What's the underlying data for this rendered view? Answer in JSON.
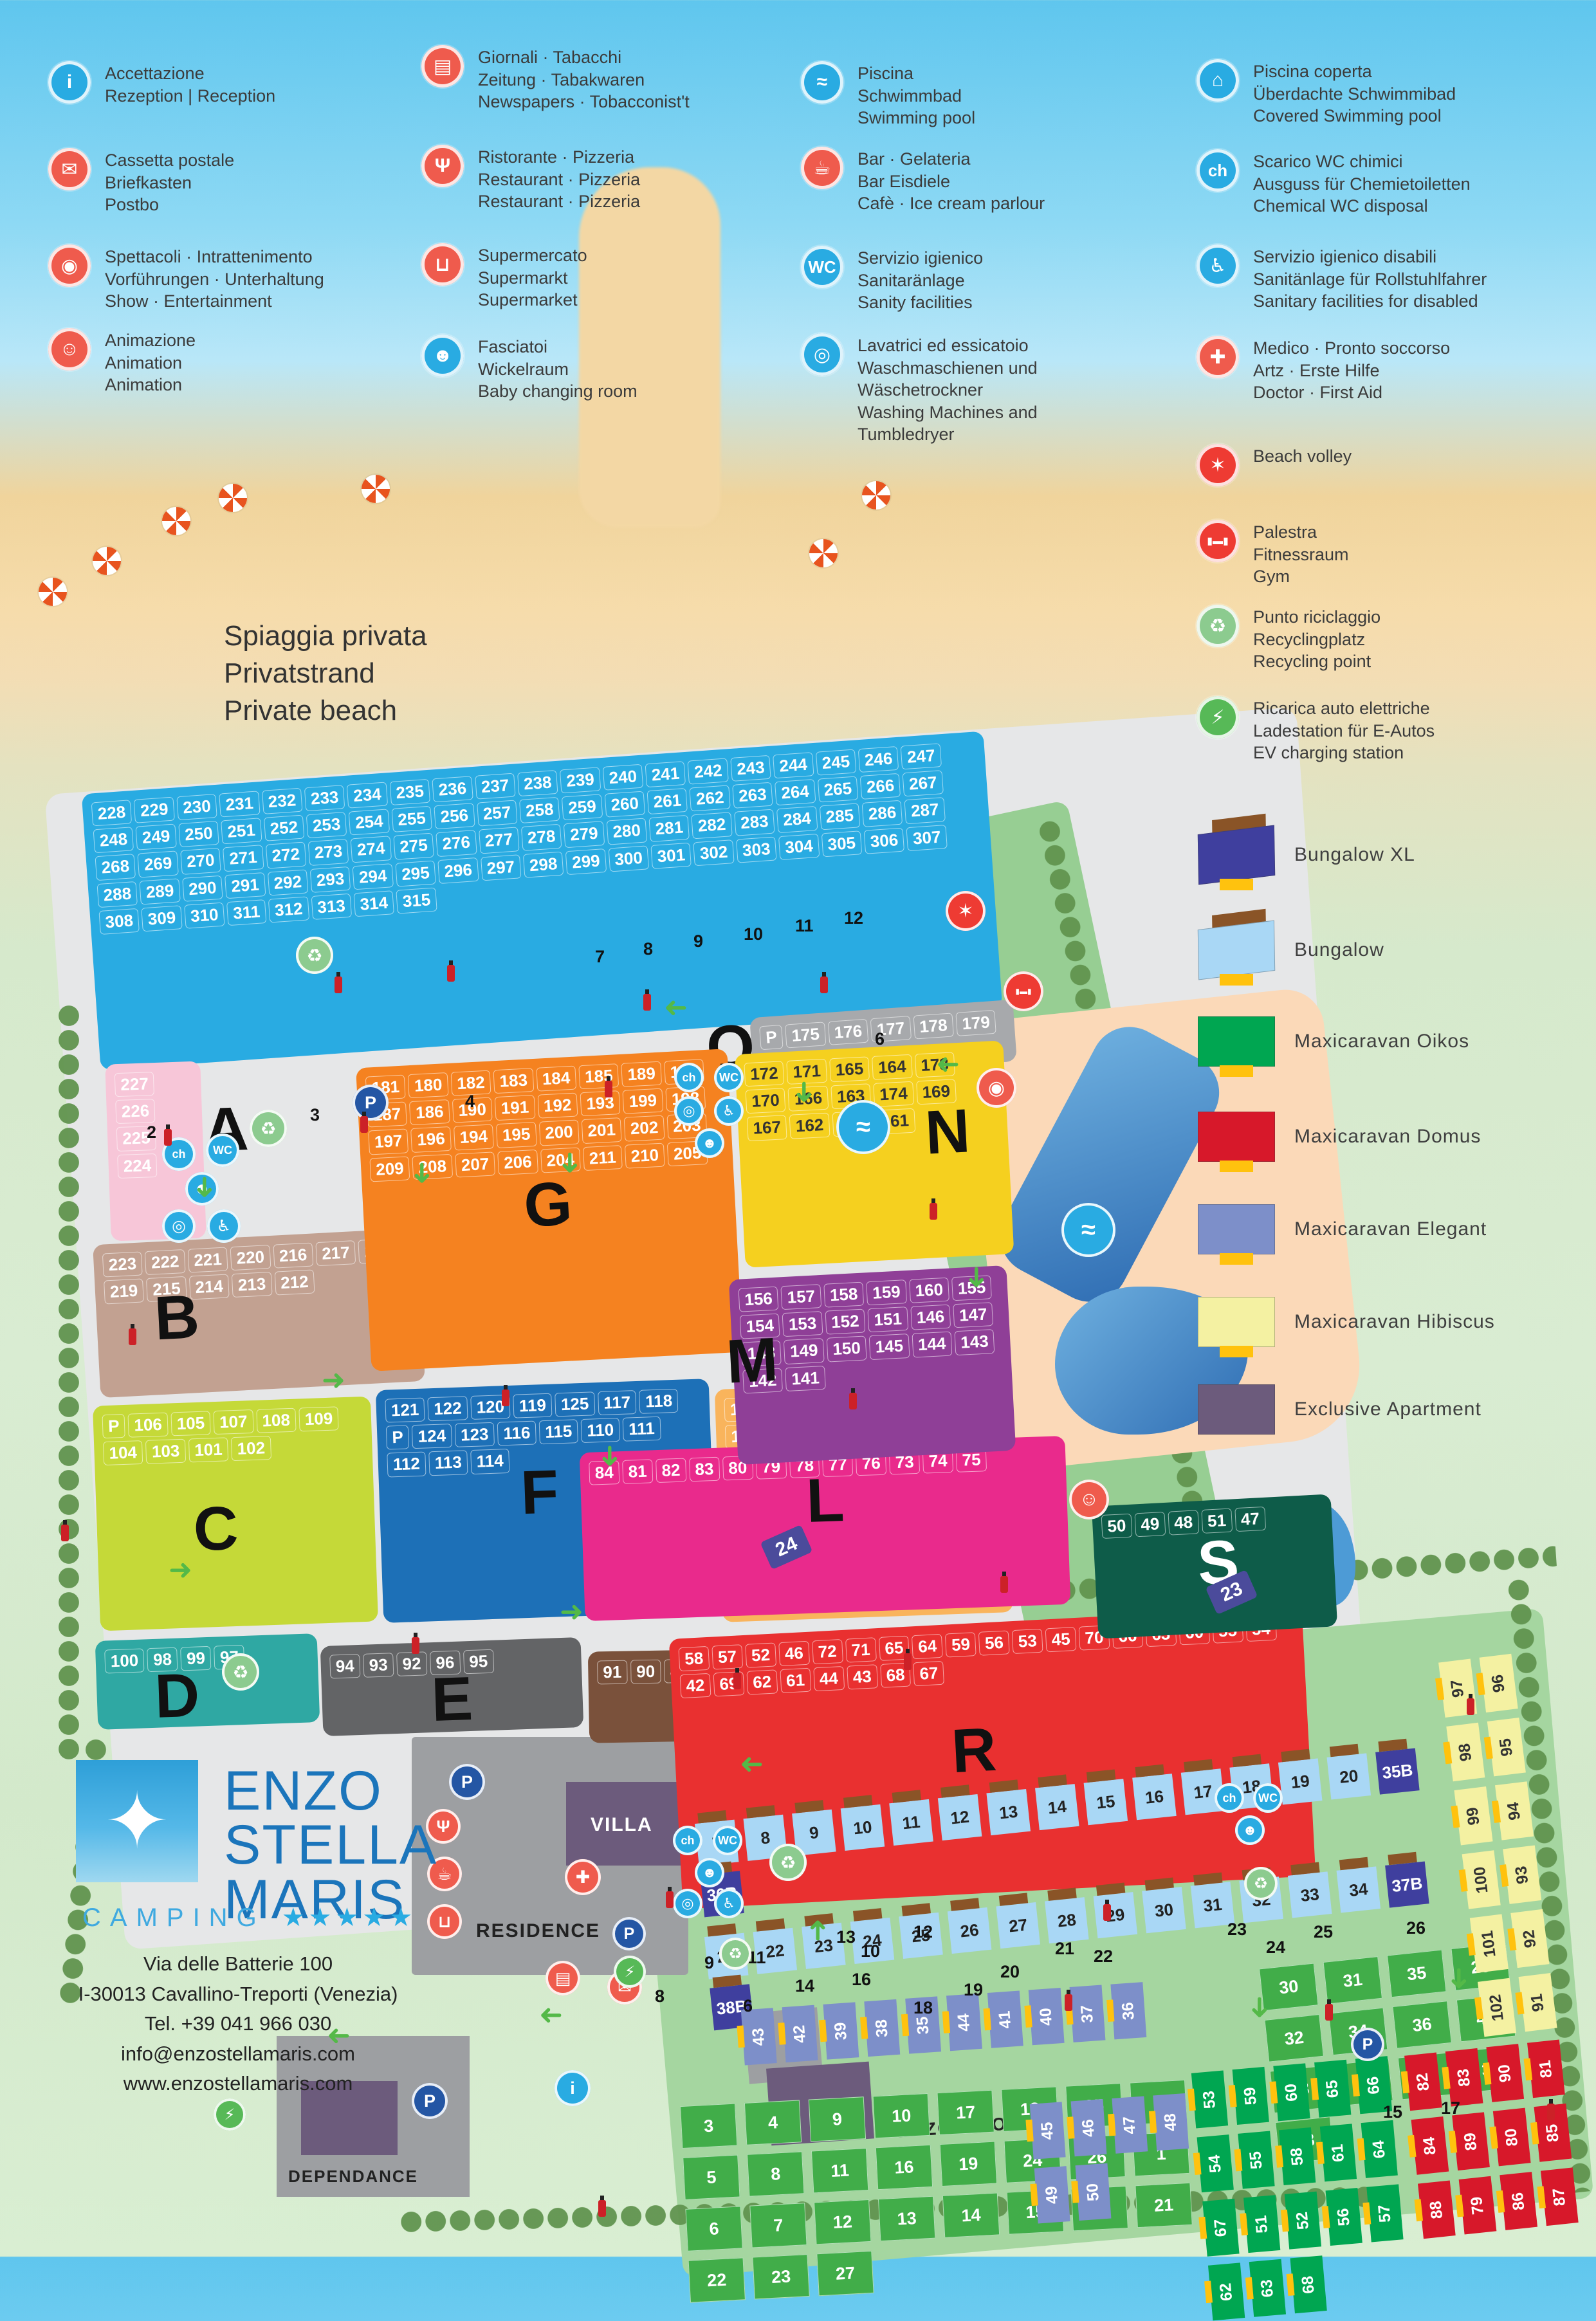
{
  "legend": {
    "columns": [
      [
        {
          "icon": "info",
          "name": "reception",
          "text": "Accettazione\nRezeption | Reception"
        },
        {
          "icon": "mailbox",
          "name": "postbox",
          "text": "Cassetta postale\nBriefkasten\nPostbo"
        },
        {
          "icon": "show",
          "name": "entertainment",
          "text": "Spettacoli · Intrattenimento\nVorführungen · Unterhaltung\nShow · Entertainment"
        },
        {
          "icon": "animation",
          "name": "animation",
          "text": "Animazione\nAnimation\nAnimation"
        }
      ],
      [
        {
          "icon": "news",
          "name": "newspapers",
          "text": "Giornali · Tabacchi\nZeitung · Tabakwaren\nNewspapers · Tobacconist't"
        },
        {
          "icon": "restaurant",
          "name": "restaurant",
          "text": "Ristorante · Pizzeria\nRestaurant · Pizzeria\nRestaurant · Pizzeria"
        },
        {
          "icon": "supermarket",
          "name": "supermarket",
          "text": "Supermercato\nSupermarkt\nSupermarket"
        },
        {
          "icon": "baby",
          "name": "baby-changing",
          "text": "Fasciatoi\nWickelraum\nBaby changing room"
        }
      ],
      [
        {
          "icon": "pool",
          "name": "swimming-pool",
          "text": "Piscina\nSchwimmbad\nSwimming pool"
        },
        {
          "icon": "bar",
          "name": "bar",
          "text": "Bar · Gelateria\nBar Eisdiele\nCafè · Ice cream parlour"
        },
        {
          "icon": "wc",
          "name": "sanitary",
          "text": "Servizio igienico\nSanitaränlage\nSanity facilities"
        },
        {
          "icon": "laundry",
          "name": "laundry",
          "text": "Lavatrici ed essicatoio\nWaschmaschienen und\nWäschetrockner\nWashing Machines and\nTumbledryer"
        }
      ],
      [
        {
          "icon": "covered_pool",
          "name": "covered-pool",
          "text": "Piscina coperta\nÜberdachte Schwimmibad\nCovered Swimming pool"
        },
        {
          "icon": "chemical",
          "name": "chemical-wc",
          "text": "Scarico WC chimici\nAusguss für Chemietoiletten\nChemical WC disposal"
        },
        {
          "icon": "disabled",
          "name": "disabled-sanitary",
          "text": "Servizio igienico disabili\nSanitänlage für Rollstuhlfahrer\nSanitary facilities for disabled"
        },
        {
          "icon": "medic",
          "name": "first-aid",
          "text": "Medico · Pronto soccorso\nArtz · Erste Hilfe\nDoctor · First Aid"
        },
        {
          "icon": "volley",
          "name": "beach-volley",
          "text": "Beach volley"
        },
        {
          "icon": "gym",
          "name": "gym",
          "text": "Palestra\nFitnessraum\nGym"
        },
        {
          "icon": "recycle",
          "name": "recycling",
          "text": "Punto riciclaggio\nRecyclingplatz\nRecycling point"
        },
        {
          "icon": "ev",
          "name": "ev-charging",
          "text": "Ricarica auto elettriche\nLadestation für E-Autos\nEV charging station"
        }
      ]
    ]
  },
  "accommodation": [
    {
      "type": "house",
      "color": "#3f3f9e",
      "label": "Bungalow XL"
    },
    {
      "type": "house",
      "color": "#a9d7f5",
      "label": "Bungalow"
    },
    {
      "type": "flat",
      "color": "#00a651",
      "label": "Maxicaravan Oikos"
    },
    {
      "type": "flat",
      "color": "#d7182a",
      "label": "Maxicaravan Domus"
    },
    {
      "type": "flat",
      "color": "#7d8fc9",
      "label": "Maxicaravan Elegant"
    },
    {
      "type": "flat",
      "color": "#f4f1a2",
      "label": "Maxicaravan Hibiscus"
    },
    {
      "type": "plain",
      "color": "#6c5b7c",
      "label": "Exclusive Apartment"
    }
  ],
  "beach_label": "Spiaggia privata\nPrivatstrand\nPrivate beach",
  "icons": {
    "info": {
      "glyph": "i",
      "bg": "#29abe2"
    },
    "mailbox": {
      "glyph": "✉",
      "bg": "#ef5b4d"
    },
    "show": {
      "glyph": "◉",
      "bg": "#ef5b4d"
    },
    "animation": {
      "glyph": "☺",
      "bg": "#ef5b4d"
    },
    "news": {
      "glyph": "▤",
      "bg": "#ef5b4d"
    },
    "restaurant": {
      "glyph": "Ψ",
      "bg": "#ef5b4d"
    },
    "supermarket": {
      "glyph": "⊔",
      "bg": "#ef5b4d"
    },
    "baby": {
      "glyph": "☻",
      "bg": "#29abe2"
    },
    "pool": {
      "glyph": "≈",
      "bg": "#29abe2"
    },
    "bar": {
      "glyph": "☕",
      "bg": "#ef5b4d"
    },
    "wc": {
      "glyph": "WC",
      "bg": "#29abe2"
    },
    "laundry": {
      "glyph": "◎",
      "bg": "#29abe2"
    },
    "covered_pool": {
      "glyph": "⌂",
      "bg": "#29abe2"
    },
    "chemical": {
      "glyph": "ch",
      "bg": "#29abe2"
    },
    "disabled": {
      "glyph": "♿",
      "bg": "#29abe2"
    },
    "medic": {
      "glyph": "✚",
      "bg": "#ef5b4d"
    },
    "volley": {
      "glyph": "✶",
      "bg": "#ee3b33"
    },
    "gym": {
      "glyph": "▮▬▮",
      "bg": "#ee3b33"
    },
    "recycle": {
      "glyph": "♻",
      "bg": "#8ccb8f"
    },
    "ev": {
      "glyph": "⚡",
      "bg": "#57b957"
    },
    "parking": {
      "glyph": "P",
      "bg": "#2456a4"
    },
    "fire_extinguisher": {
      "glyph": "",
      "bg": "#cc2127"
    }
  },
  "map": {
    "zones": [
      {
        "id": "blue",
        "letter": "",
        "color": "#29abe2",
        "text": "#ffffff",
        "plots": [
          "228",
          "229",
          "230",
          "231",
          "232",
          "233",
          "234",
          "235",
          "236",
          "237",
          "238",
          "239",
          "240",
          "241",
          "242",
          "243",
          "244",
          "245",
          "246",
          "247",
          "248",
          "249",
          "250",
          "251",
          "252",
          "253",
          "254",
          "255",
          "256",
          "257",
          "258",
          "259",
          "260",
          "261",
          "262",
          "263",
          "264",
          "265",
          "266",
          "267",
          "268",
          "269",
          "270",
          "271",
          "272",
          "273",
          "274",
          "275",
          "276",
          "277",
          "278",
          "279",
          "280",
          "281",
          "282",
          "283",
          "284",
          "285",
          "286",
          "287",
          "288",
          "289",
          "290",
          "291",
          "292",
          "293",
          "294",
          "295",
          "296",
          "297",
          "298",
          "299",
          "300",
          "301",
          "302",
          "303",
          "304",
          "305",
          "306",
          "307",
          "308",
          "309",
          "310",
          "311",
          "312",
          "313",
          "314",
          "315"
        ]
      },
      {
        "id": "o",
        "letter": "O",
        "letter_color": "#111",
        "color": "#a7a9ac",
        "text": "#ffffff",
        "plots": [
          "P",
          "175",
          "176",
          "177",
          "178",
          "179"
        ]
      },
      {
        "id": "a",
        "letter": "A",
        "letter_color": "#111",
        "color": "#f7c6d8",
        "text": "#ffffff",
        "plots": [
          "227",
          "226",
          "225",
          "224"
        ]
      },
      {
        "id": "b",
        "letter": "B",
        "letter_color": "#111",
        "color": "#c2a191",
        "text": "#ffffff",
        "plots": [
          "223",
          "222",
          "221",
          "220",
          "216",
          "217",
          "218",
          "219",
          "215",
          "214",
          "213",
          "212"
        ]
      },
      {
        "id": "c",
        "letter": "C",
        "letter_color": "#111",
        "color": "#c5d938",
        "text": "#ffffff",
        "plots": [
          "P",
          "106",
          "105",
          "107",
          "108",
          "109",
          "104",
          "103",
          "101",
          "102"
        ]
      },
      {
        "id": "d",
        "letter": "D",
        "letter_color": "#111",
        "color": "#2fa8a3",
        "text": "#ffffff",
        "plots": [
          "100",
          "98",
          "99",
          "97"
        ]
      },
      {
        "id": "e",
        "letter": "E",
        "letter_color": "#111",
        "color": "#636466",
        "text": "#ffffff",
        "plots": [
          "94",
          "93",
          "92",
          "96",
          "95"
        ]
      },
      {
        "id": "f",
        "letter": "F",
        "letter_color": "#111",
        "color": "#1d70b7",
        "text": "#ffffff",
        "plots": [
          "121",
          "122",
          "120",
          "119",
          "125",
          "117",
          "118",
          "P",
          "124",
          "123",
          "116",
          "115",
          "110",
          "111",
          "112",
          "113",
          "114"
        ]
      },
      {
        "id": "g",
        "letter": "G",
        "letter_color": "#111",
        "color": "#f58220",
        "text": "#ffffff",
        "plots": [
          "181",
          "180",
          "182",
          "183",
          "184",
          "185",
          "189",
          "188",
          "187",
          "186",
          "190",
          "191",
          "192",
          "193",
          "199",
          "198",
          "197",
          "196",
          "194",
          "195",
          "200",
          "201",
          "202",
          "203",
          "209",
          "208",
          "207",
          "206",
          "204",
          "211",
          "210",
          "205"
        ]
      },
      {
        "id": "i",
        "letter": "I",
        "letter_color": "#111",
        "color": "#7a513b",
        "text": "#ffffff",
        "plots": [
          "91",
          "90",
          "89",
          "88",
          "87",
          "86",
          "85"
        ]
      },
      {
        "id": "k",
        "letter": "K",
        "letter_color": "#111",
        "color": "#f9b45c",
        "text": "#ffffff",
        "plots": [
          "130",
          "129",
          "131",
          "138",
          "128",
          "132",
          "137",
          "127",
          "133",
          "136",
          "139",
          "126",
          "134",
          "135",
          "140"
        ]
      },
      {
        "id": "l",
        "letter": "L",
        "letter_color": "#111",
        "color": "#e92a8c",
        "text": "#ffffff",
        "plots": [
          "84",
          "81",
          "82",
          "83",
          "80",
          "79",
          "78",
          "77",
          "76",
          "73",
          "74",
          "75"
        ]
      },
      {
        "id": "m",
        "letter": "M",
        "letter_color": "#111",
        "color": "#8f3f97",
        "text": "#ffffff",
        "plots": [
          "156",
          "157",
          "158",
          "159",
          "160",
          "155",
          "154",
          "153",
          "152",
          "151",
          "146",
          "147",
          "148",
          "149",
          "150",
          "145",
          "144",
          "143",
          "142",
          "141"
        ]
      },
      {
        "id": "n",
        "letter": "N",
        "letter_color": "#111",
        "color": "#f5d01f",
        "text": "#333333",
        "plots": [
          "172",
          "171",
          "165",
          "164",
          "173",
          "170",
          "166",
          "163",
          "174",
          "169",
          "167",
          "162",
          "168",
          "161"
        ]
      },
      {
        "id": "r",
        "letter": "R",
        "letter_color": "#111",
        "color": "#e93030",
        "text": "#ffffff",
        "plots": [
          "58",
          "57",
          "52",
          "46",
          "72",
          "71",
          "65",
          "64",
          "59",
          "56",
          "53",
          "45",
          "70",
          "66",
          "63",
          "60",
          "55",
          "54",
          "42",
          "69",
          "62",
          "61",
          "44",
          "43",
          "68",
          "67"
        ]
      },
      {
        "id": "s",
        "letter": "S",
        "letter_color": "#ffffff",
        "color": "#0e5c49",
        "text": "#ffffff",
        "plots": [
          "50",
          "49",
          "48",
          "51",
          "47"
        ]
      }
    ],
    "unit_groups": [
      {
        "id": "bung1",
        "kind": "bungalow",
        "text": "#222",
        "units": [
          "7",
          "8",
          "9",
          "10",
          "11",
          "12",
          "13",
          "14",
          "15",
          "16",
          "17",
          "18",
          "19",
          "20",
          "35B",
          "36B"
        ]
      },
      {
        "id": "bung2",
        "kind": "bungalow",
        "text": "#222",
        "units": [
          "21",
          "22",
          "23",
          "24",
          "25",
          "26",
          "27",
          "28",
          "29",
          "30",
          "31",
          "32",
          "33",
          "34",
          "37B",
          "38B"
        ]
      },
      {
        "id": "eleg_a",
        "kind": "elegant",
        "units": [
          "43",
          "42",
          "39",
          "38",
          "35",
          "44",
          "41",
          "40",
          "37",
          "36"
        ]
      },
      {
        "id": "green2",
        "kind": "green",
        "units": [
          "30",
          "31",
          "35",
          "29",
          "32",
          "34",
          "36",
          "40",
          "28",
          "33",
          "37",
          "39",
          "38"
        ]
      },
      {
        "id": "green1",
        "kind": "green",
        "units": [
          "3",
          "4",
          "9",
          "10",
          "17",
          "18",
          "25",
          "2",
          "5",
          "8",
          "11",
          "16",
          "19",
          "24",
          "26",
          "1",
          "6",
          "7",
          "12",
          "13",
          "14",
          "15",
          "20",
          "21",
          "22",
          "23",
          "27"
        ]
      },
      {
        "id": "eleg_b",
        "kind": "elegant",
        "units": [
          "45",
          "46",
          "47",
          "48",
          "49",
          "50"
        ]
      },
      {
        "id": "oikos",
        "kind": "oikos",
        "units": [
          "53",
          "59",
          "60",
          "65",
          "66",
          "54",
          "55",
          "58",
          "61",
          "64",
          "67",
          "51",
          "52",
          "56",
          "57",
          "62",
          "63",
          "68"
        ]
      },
      {
        "id": "domus",
        "kind": "domus",
        "units": [
          "82",
          "83",
          "90",
          "81",
          "84",
          "89",
          "80",
          "85",
          "88",
          "79",
          "86",
          "87"
        ]
      },
      {
        "id": "hibiscus",
        "kind": "hibiscus",
        "units": [
          "97",
          "96",
          "98",
          "95",
          "99",
          "94",
          "100",
          "93",
          "101",
          "92",
          "102",
          "91"
        ]
      }
    ],
    "signs": [
      "24",
      "23"
    ],
    "road_markers": [
      "2",
      "3",
      "4",
      "5",
      "6",
      "7",
      "8",
      "9",
      "10",
      "11",
      "12",
      "6",
      "8",
      "9",
      "10",
      "11",
      "12",
      "13",
      "14",
      "15",
      "16",
      "17",
      "18",
      "19",
      "20",
      "21",
      "22",
      "23",
      "24",
      "25",
      "26"
    ],
    "buildings": {
      "villa": "VILLA",
      "residence": "RESIDENCE",
      "dependance": "DEPENDANCE",
      "enzos_home": "ENZO'S HOME"
    }
  },
  "brand": {
    "logo_star": "✦",
    "name_lines": [
      "ENZO",
      "STELLA",
      "MARIS"
    ],
    "camping": "CAMPING",
    "stars": "★★★★★",
    "address": [
      "Via delle Batterie 100",
      "I-30013 Cavallino-Treporti (Venezia)",
      "Tel. +39 041 966 030",
      "info@enzostellamaris.com",
      "www.enzostellamaris.com"
    ]
  }
}
